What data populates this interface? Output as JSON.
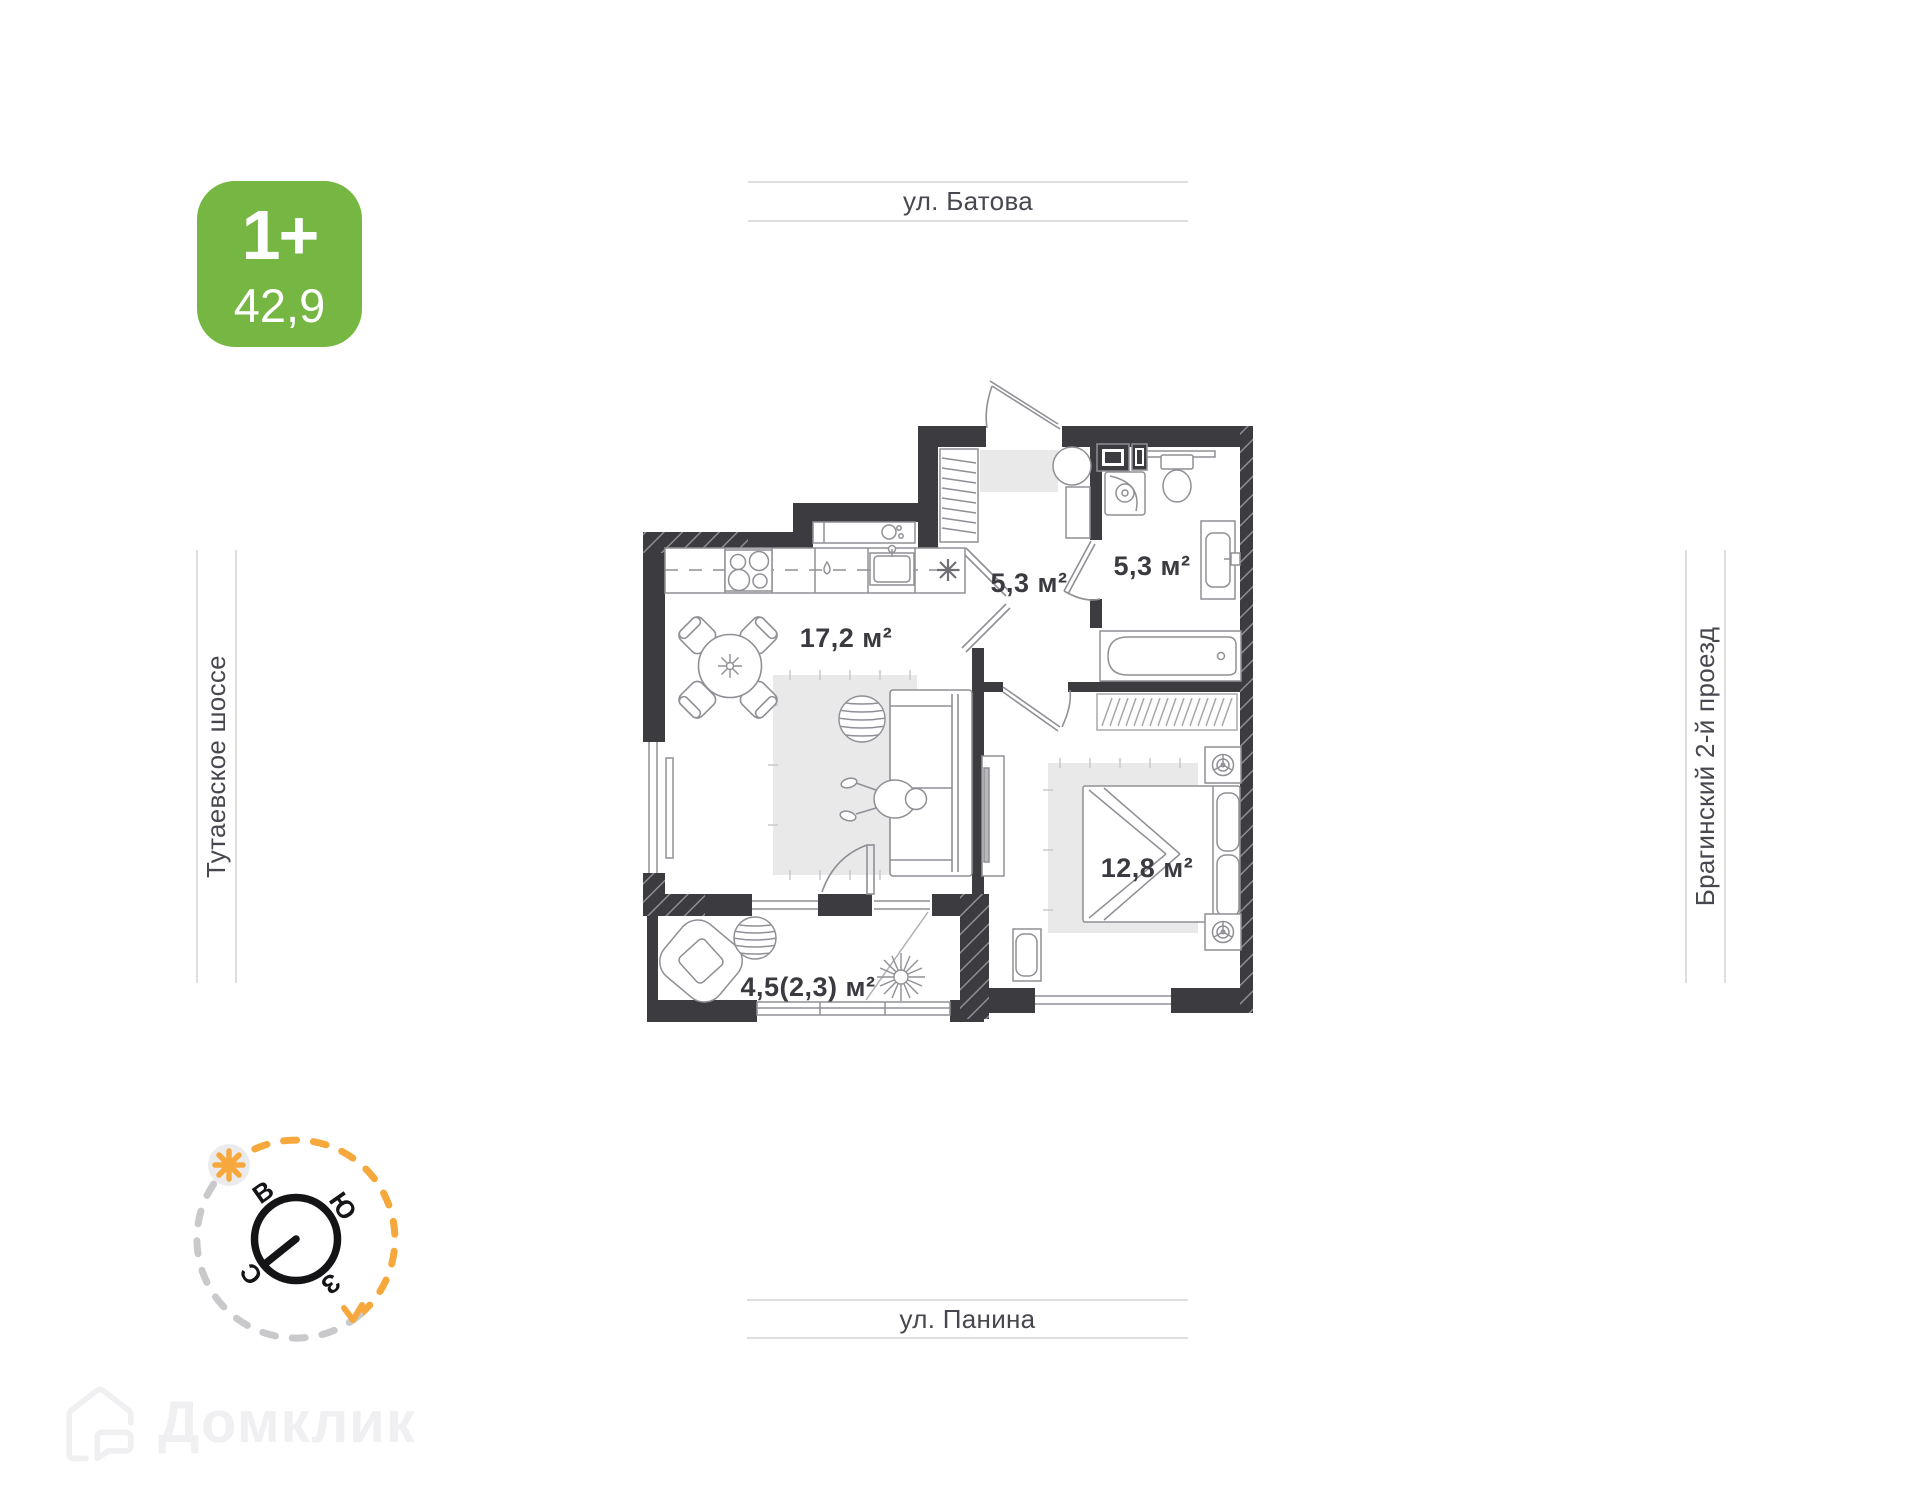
{
  "badge": {
    "rooms_label": "1+",
    "area_value": "42,9"
  },
  "streets": {
    "top": "ул. Батова",
    "bottom": "ул. Панина",
    "left": "Тутаевское шоссе",
    "right": "Брагинский 2-й проезд"
  },
  "plan": {
    "rooms": {
      "kitchen_living": {
        "label": "17,2 м²"
      },
      "hallway": {
        "label": "5,3 м²"
      },
      "bathroom": {
        "label": "5,3 м²"
      },
      "bedroom": {
        "label": "12,8 м²"
      },
      "balcony": {
        "label": "4,5(2,3) м²"
      }
    }
  },
  "compass": {
    "north": "С",
    "east": "В",
    "south": "Ю",
    "west": "З"
  },
  "watermark": {
    "brand": "Домклик"
  },
  "colors": {
    "badge_green": "#76b643",
    "wall_dark": "#3b3b40",
    "accent_orange": "#f6a83c",
    "street_text": "#47474f",
    "band_line": "#dedede",
    "rug_gray": "#e9e9ea"
  }
}
